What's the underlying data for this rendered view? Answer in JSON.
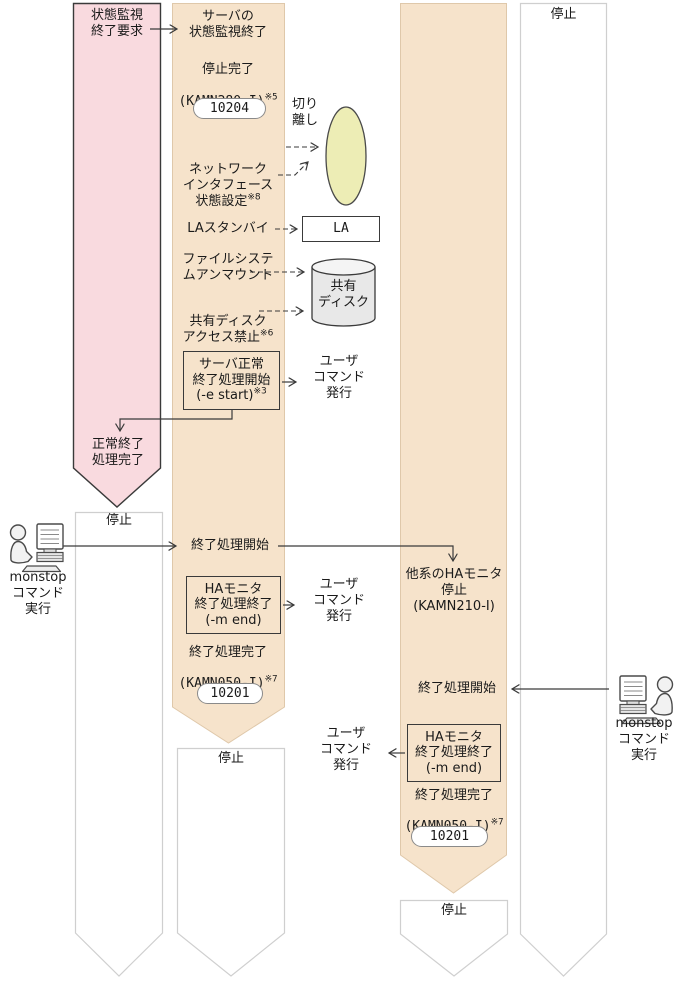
{
  "colors": {
    "lane_pink": "#F9DADF",
    "lane_tan": "#F6E3CB",
    "lane_white": "#FFFFFF",
    "lane_border_dark": "#3A3A3A",
    "lane_border_light": "#CFCFCF",
    "lane_border_tan": "#DFC8AA",
    "ellipse_fill": "#EDEDB5",
    "cylinder_fill": "#E8E8E8",
    "cylinder_top_fill": "#F4F4F4",
    "arrow": "#3A3A3A"
  },
  "lane1": {
    "top_label": "状態監視\n終了要求",
    "normal_end_label": "正常終了\n処理完了",
    "stopped_label": "停止"
  },
  "lane2": {
    "top_label": "サーバの\n状態監視終了",
    "stop_complete": "停止完了",
    "stop_complete_code": "(KAMN280-I)",
    "stop_complete_note": "※5",
    "badge_10204": "10204",
    "network_label": "ネットワーク\nインタフェース\n状態設定",
    "network_note": "※8",
    "la_standby": "LAスタンバイ",
    "fs_unmount": "ファイルシステ\nムアンマウント",
    "disk_forbid": "共有ディスク\nアクセス禁止",
    "disk_forbid_note": "※6",
    "server_end_box": "サーバ正常\n終了処理開始\n(-e start)",
    "server_end_note": "※3",
    "user_cmd1": "ユーザ\nコマンド\n発行",
    "shutdown_start": "終了処理開始",
    "ha_end_box": "HAモニタ\n終了処理終了\n(-m end)",
    "user_cmd2": "ユーザ\nコマンド\n発行",
    "end_complete": "終了処理完了",
    "end_complete_code": "(KAMN050-I)",
    "end_complete_note": "※7",
    "badge_10201": "10201",
    "stopped_label": "停止"
  },
  "lane3": {
    "other_ha_stop": "他系のHAモニタ\n停止\n(KAMN210-I)",
    "shutdown_start": "終了処理開始",
    "ha_end_box": "HAモニタ\n終了処理終了\n(-m end)",
    "user_cmd": "ユーザ\nコマンド\n発行",
    "end_complete": "終了処理完了",
    "end_complete_code": "(KAMN050-I)",
    "end_complete_note": "※7",
    "badge_10201": "10201",
    "stopped_label": "停止"
  },
  "lane4": {
    "stopped_label": "停止"
  },
  "annotations": {
    "detach": "切り\n離し",
    "la_box": "LA",
    "shared_disk": "共有\nディスク",
    "monstop_left": "monstop\nコマンド\n実行",
    "monstop_right": "monstop\nコマンド\n実行"
  }
}
